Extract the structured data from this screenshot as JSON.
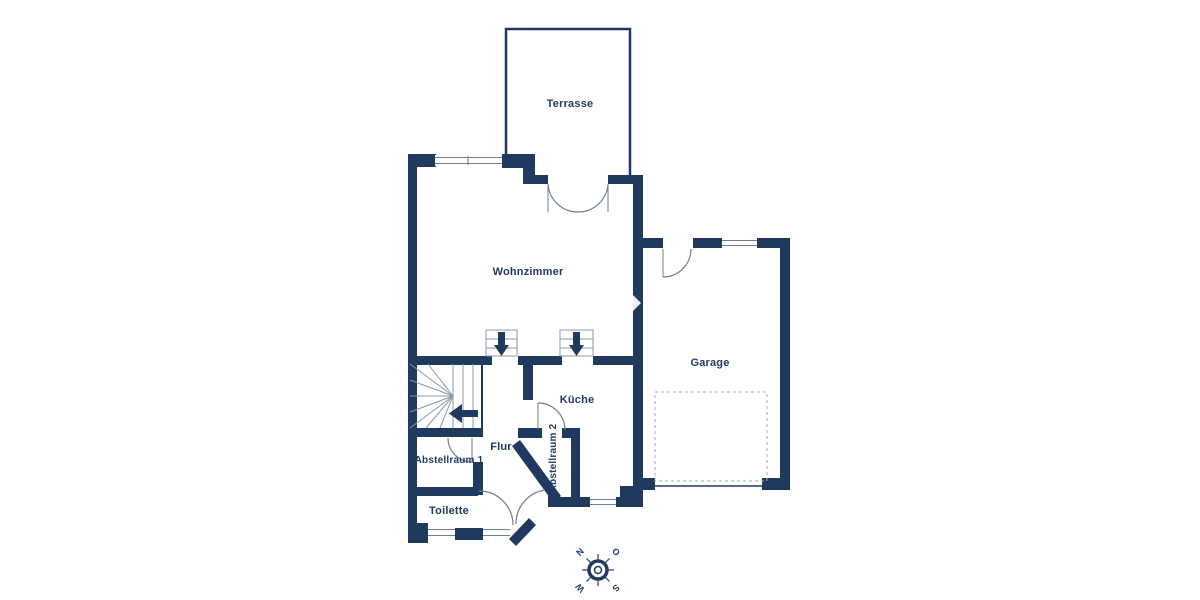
{
  "palette": {
    "wall": "#1f3a5e",
    "line": "#6f7f8f",
    "stair_line": "#8c99a7",
    "dash": "#a6aeb6",
    "text": "#1f3a5e",
    "background": "#ffffff"
  },
  "floorplan": {
    "rooms": [
      {
        "id": "terrasse",
        "label": "Terrasse"
      },
      {
        "id": "wohnzimmer",
        "label": "Wohnzimmer"
      },
      {
        "id": "garage",
        "label": "Garage"
      },
      {
        "id": "kueche",
        "label": "Küche"
      },
      {
        "id": "flur",
        "label": "Flur"
      },
      {
        "id": "abstellraum1",
        "label": "Abstellraum 1"
      },
      {
        "id": "abstellraum2",
        "label": "Abstellraum 2"
      },
      {
        "id": "toilette",
        "label": "Toilette"
      }
    ],
    "compass": {
      "north": "N",
      "east": "O",
      "south": "S",
      "west": "W"
    }
  }
}
